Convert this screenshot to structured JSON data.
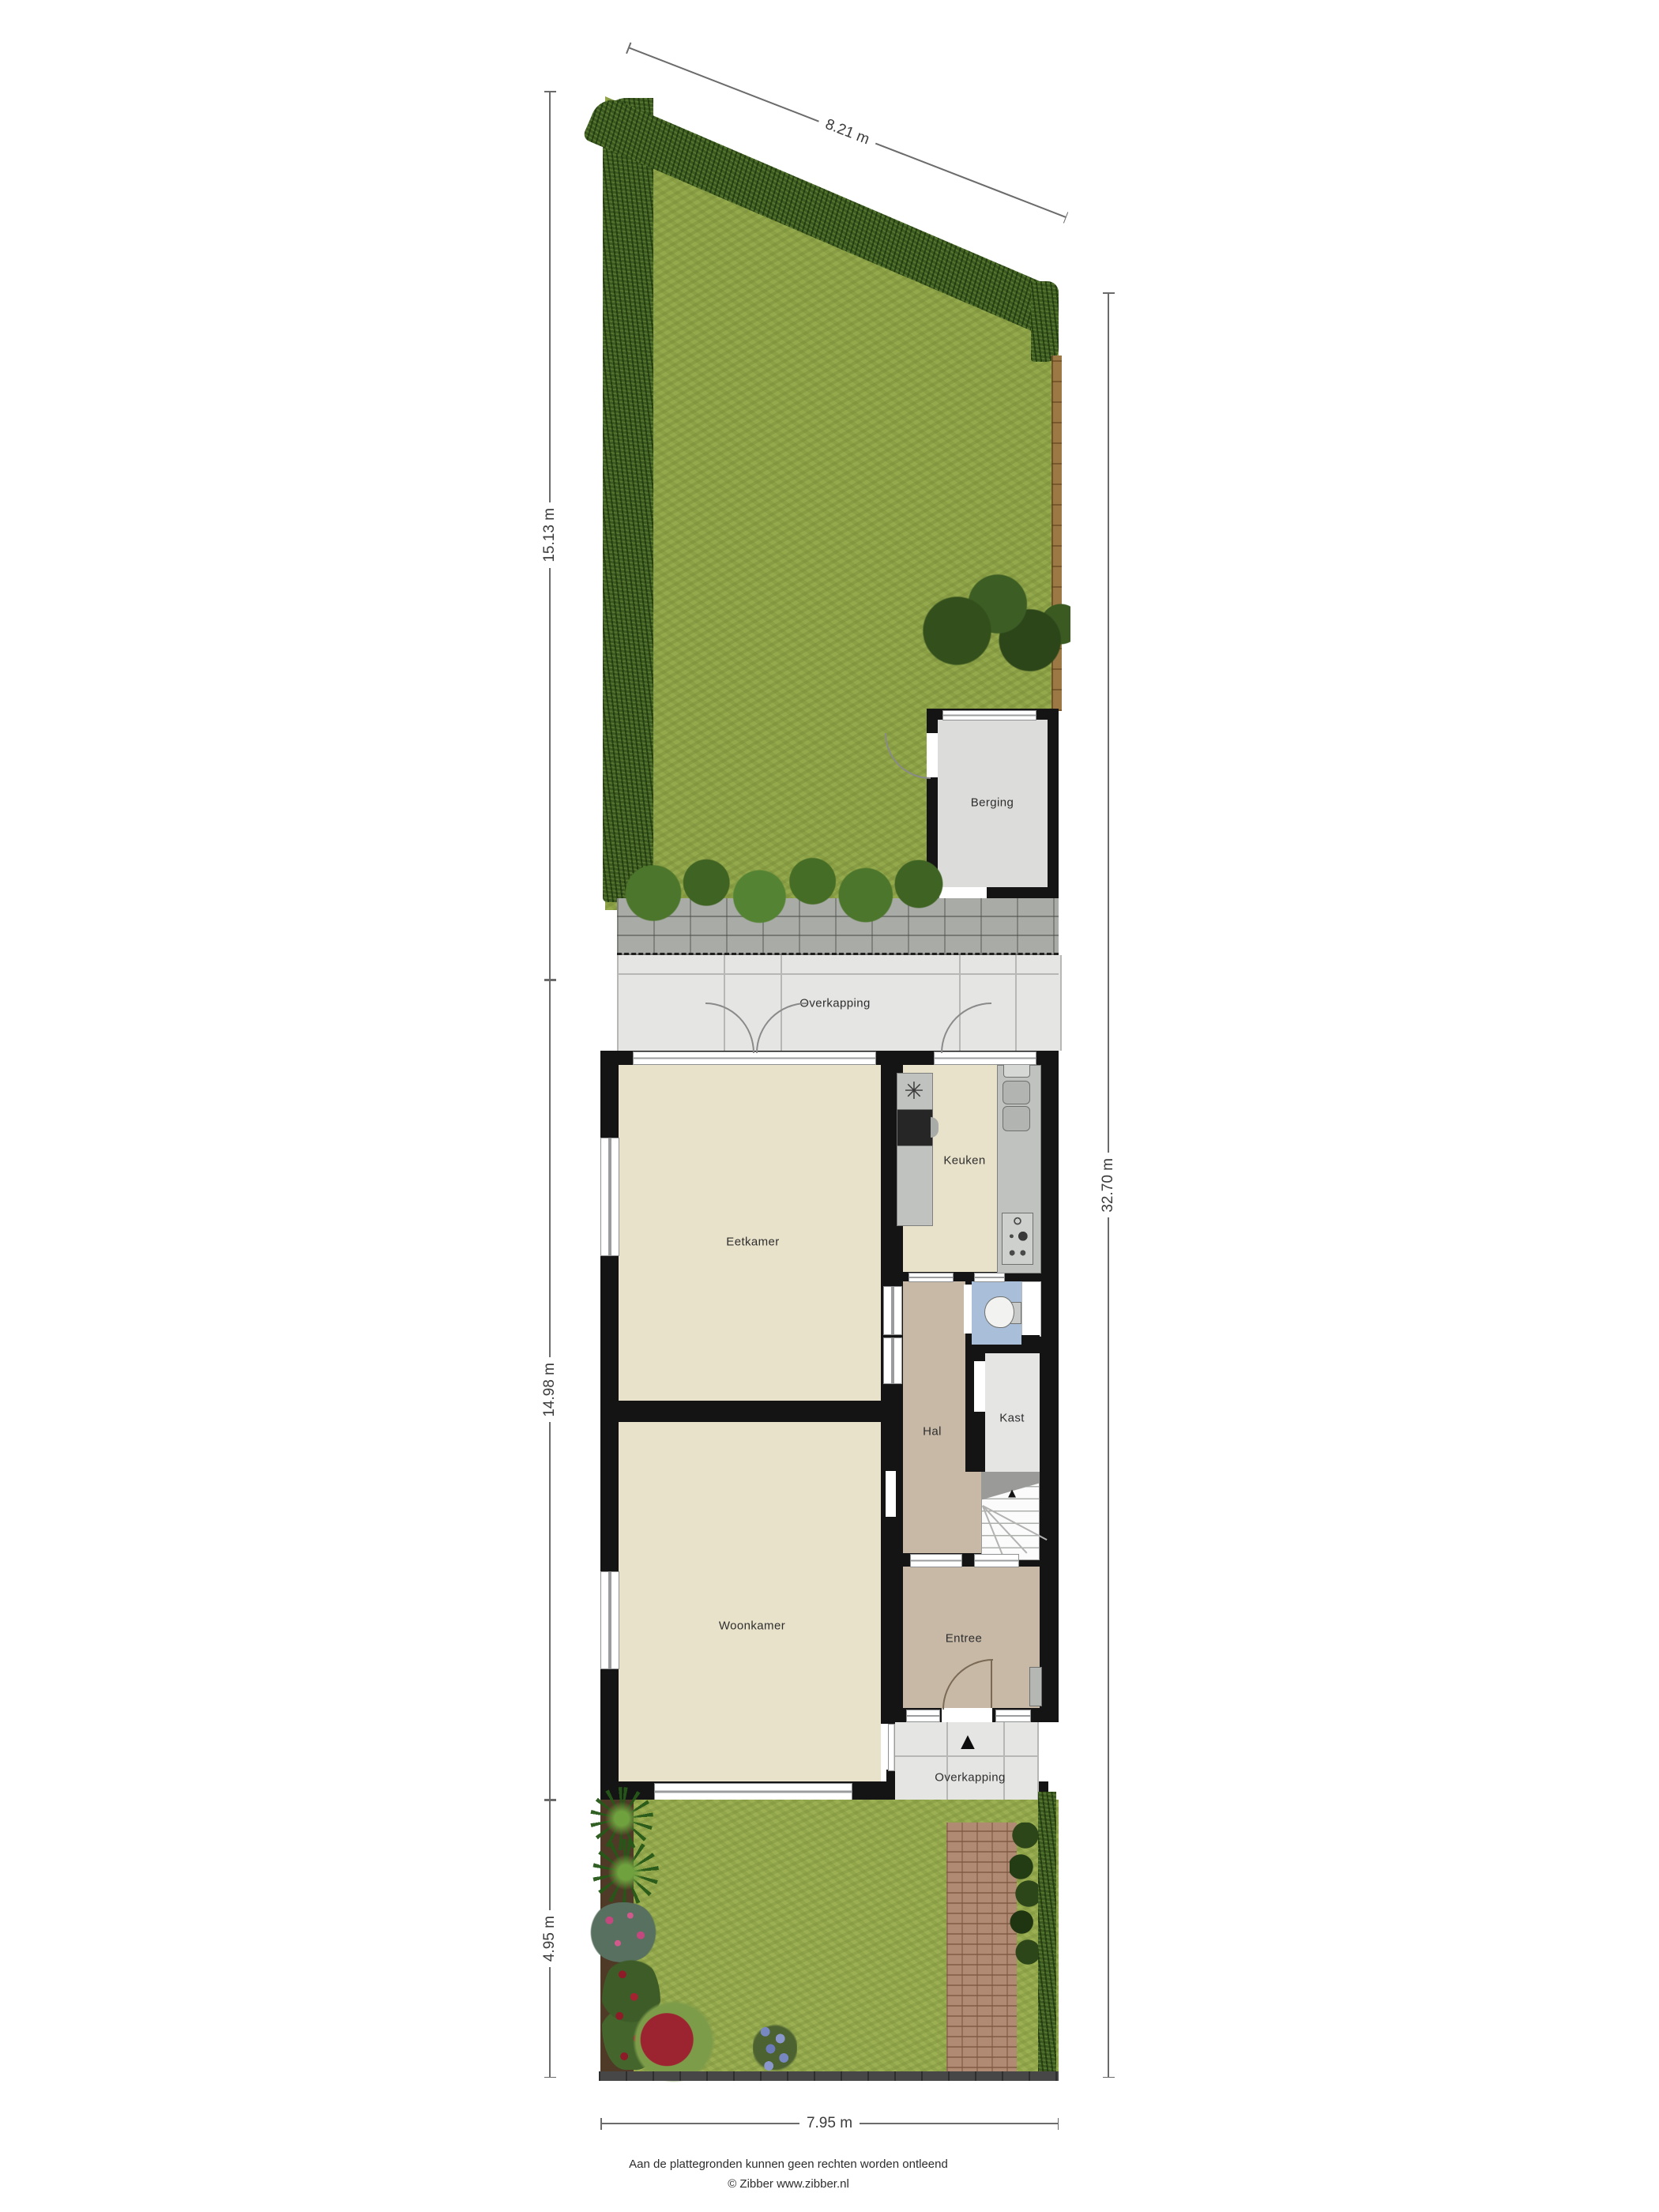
{
  "plan": {
    "title": "Situatie plattegrond (begane grond met tuin)",
    "rooms": [
      {
        "id": "berging",
        "label": "Berging"
      },
      {
        "id": "overkapping_top",
        "label": "Overkapping"
      },
      {
        "id": "eetkamer",
        "label": "Eetkamer"
      },
      {
        "id": "keuken",
        "label": "Keuken"
      },
      {
        "id": "hal",
        "label": "Hal"
      },
      {
        "id": "kast",
        "label": "Kast"
      },
      {
        "id": "woonkamer",
        "label": "Woonkamer"
      },
      {
        "id": "entree",
        "label": "Entree"
      },
      {
        "id": "overkapping_bottom",
        "label": "Overkapping"
      }
    ],
    "dimensions": {
      "top_sloped": "8.21 m",
      "left_upper": "15.13 m",
      "left_middle": "14.98 m",
      "left_lower": "4.95 m",
      "right_full": "32.70 m",
      "bottom": "7.95 m"
    },
    "icons": {
      "north_arrow": "▲",
      "stairs_up_arrow": "▲",
      "extractor_fan": "✳"
    },
    "colors": {
      "lawn": "#94a84c",
      "hedge": "#3c5a20",
      "paving_grey": "#a9aba7",
      "brick_path": "#b18a73",
      "wall": "#141414",
      "floor_living": "#e9e2cb",
      "floor_hall": "#c8b9a7",
      "floor_shed": "#dcdddb",
      "floor_canopy": "#e5e6e4",
      "floor_toilet": "#a9bed9",
      "fence_wood": "#9b7844"
    },
    "footer": {
      "disclaimer": "Aan de plattegronden kunnen geen rechten worden ontleend",
      "credit": "© Zibber www.zibber.nl"
    }
  }
}
